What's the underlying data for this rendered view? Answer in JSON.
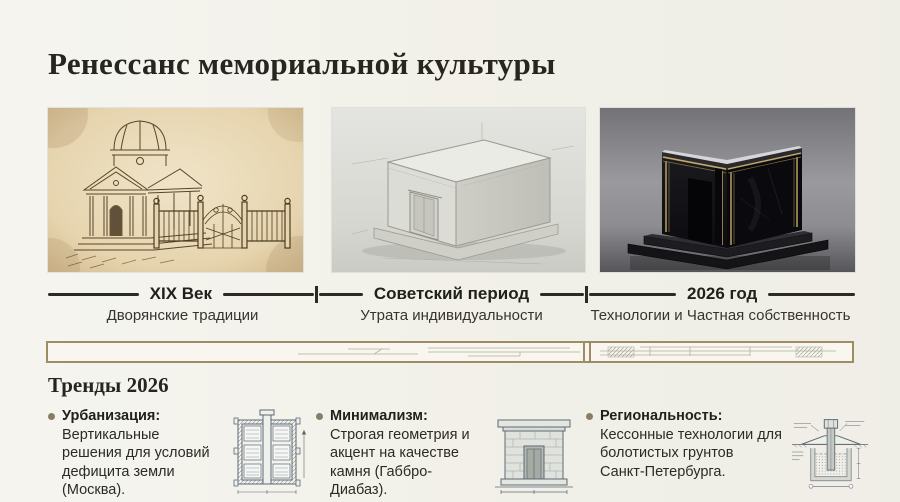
{
  "title": "Ренессанс мемориальной культуры",
  "timeline": {
    "eras": [
      {
        "label": "XIX Век",
        "sublabel": "Дворянские традиции",
        "image": "sepia-sketch-classical-domed-mausoleum-with-wrought-iron-gate"
      },
      {
        "label": "Советский период",
        "sublabel": "Утрата индивидуальности",
        "image": "plain-gray-concrete-box-tomb"
      },
      {
        "label": "2026 год",
        "sublabel": "Технологии и Частная собственность",
        "image": "black-granite-cube-mausoleum-with-gold-led-trim"
      }
    ]
  },
  "trends": {
    "heading": "Тренды 2026",
    "items": [
      {
        "label": "Урбанизация:",
        "text": "Вертикальные решения для условий дефицита земли (Москва).",
        "icon": "vertical-columbarium-section-blueprint"
      },
      {
        "label": "Минимализм:",
        "text": "Строгая геометрия и акцент на качестве камня (Габбро-Диабаз).",
        "icon": "stone-mausoleum-facade-blueprint"
      },
      {
        "label": "Региональность:",
        "text": "Кессонные технологии для болотистых грунтов Санкт-Петербурга.",
        "icon": "caisson-foundation-section-blueprint"
      }
    ]
  },
  "colors": {
    "background": "#f2f1ea",
    "ink": "#26261f",
    "timeline_line": "#2b2b26",
    "accent_border": "#9e8c64",
    "bullet": "#8a7d68",
    "gold_trim": "#c4ad66",
    "blueprint_stroke": "#5d6874"
  }
}
